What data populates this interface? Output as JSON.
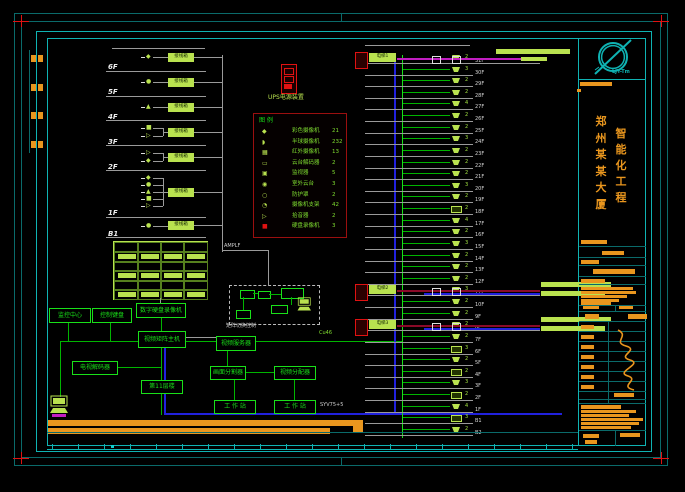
{
  "colors": {
    "teal": "#0fb3b3",
    "teal_dim": "#0a6a6a",
    "orange": "#e9961e",
    "green": "#00b400",
    "green_bright": "#19e019",
    "pale": "#b9e24f",
    "red": "#e01212",
    "blue": "#2121dd",
    "magenta": "#c21ec2",
    "maroon": "#8a0a28",
    "gray": "#9a9a9a",
    "white": "#e8e8e8"
  },
  "title_panel": {
    "logo_text": "LJY-Tm",
    "building_chars": [
      "郑",
      "州",
      "某",
      "某",
      "大",
      "厦"
    ],
    "project_chars": [
      "智",
      "能",
      "化",
      "工",
      "程"
    ]
  },
  "legend": {
    "header": "图 例",
    "items": [
      {
        "icon": "camera-icon",
        "glyph": "◆",
        "name": "彩色摄像机",
        "count": "21"
      },
      {
        "icon": "dome-camera-icon",
        "glyph": "◗",
        "name": "半球摄像机",
        "count": "232"
      },
      {
        "icon": "ir-camera-icon",
        "glyph": "▦",
        "name": "红外摄像机",
        "count": "13"
      },
      {
        "icon": "decoder-icon",
        "glyph": "▭",
        "name": "云台解码器",
        "count": "2"
      },
      {
        "icon": "monitor-icon",
        "glyph": "▣",
        "name": "监视器",
        "count": "5"
      },
      {
        "icon": "pan-tilt-icon",
        "glyph": "◉",
        "name": "室外云台",
        "count": "3"
      },
      {
        "icon": "housing-icon",
        "glyph": "○",
        "name": "防护罩",
        "count": "2"
      },
      {
        "icon": "bracket-icon",
        "glyph": "◔",
        "name": "摄像机支架",
        "count": "42"
      },
      {
        "icon": "mic-icon",
        "glyph": "▷",
        "name": "拾音器",
        "count": "2"
      },
      {
        "icon": "dvr-icon",
        "glyph": "■",
        "name": "硬盘录像机",
        "count": "3"
      }
    ]
  },
  "ups": {
    "label": "UPS电源装置"
  },
  "cables": {
    "trunk": "Cu46",
    "video": "SYV75+5",
    "amp": "AMPLF"
  },
  "left_riser": {
    "box_label": "接线箱",
    "floors": [
      {
        "label": "6F"
      },
      {
        "label": "5F"
      },
      {
        "label": "4F"
      },
      {
        "label": "3F"
      },
      {
        "label": "2F"
      },
      {
        "label": "1F"
      },
      {
        "label": "B1"
      }
    ]
  },
  "control_room": {
    "dashed_caption": "矩阵切换控制",
    "boxes": {
      "dvr": "数字硬盘录像机",
      "monitor_center": "监控中心",
      "keyboard": "控制键盘",
      "matrix": "视频矩阵主机",
      "decoder": "电视解码器",
      "floor11": "第11层楼",
      "video_server": "视频服务器",
      "splitter": "画面分割器",
      "distributor": "视频分配器",
      "ws1": "工 作 站",
      "ws2": "工 作 站"
    }
  },
  "right_riser": {
    "lift_labels": [
      "电梯1",
      "电梯2",
      "电梯3"
    ],
    "rows": [
      {
        "floor": "31F",
        "n": "2",
        "type": "dome",
        "special": 0
      },
      {
        "floor": "30F",
        "n": "3",
        "type": "dome"
      },
      {
        "floor": "29F",
        "n": "2",
        "type": "dome"
      },
      {
        "floor": "28F",
        "n": "2",
        "type": "dome"
      },
      {
        "floor": "27F",
        "n": "4",
        "type": "dome"
      },
      {
        "floor": "26F",
        "n": "2",
        "type": "dome"
      },
      {
        "floor": "25F",
        "n": "2",
        "type": "dome"
      },
      {
        "floor": "24F",
        "n": "3",
        "type": "dome"
      },
      {
        "floor": "23F",
        "n": "2",
        "type": "dome"
      },
      {
        "floor": "22F",
        "n": "2",
        "type": "dome"
      },
      {
        "floor": "21F",
        "n": "2",
        "type": "dome"
      },
      {
        "floor": "20F",
        "n": "3",
        "type": "dome"
      },
      {
        "floor": "19F",
        "n": "2",
        "type": "dome"
      },
      {
        "floor": "18F",
        "n": "2",
        "type": "box"
      },
      {
        "floor": "17F",
        "n": "4",
        "type": "dome"
      },
      {
        "floor": "16F",
        "n": "2",
        "type": "dome"
      },
      {
        "floor": "15F",
        "n": "3",
        "type": "dome"
      },
      {
        "floor": "14F",
        "n": "2",
        "type": "dome"
      },
      {
        "floor": "13F",
        "n": "2",
        "type": "dome"
      },
      {
        "floor": "12F",
        "n": "2",
        "type": "dome"
      },
      {
        "floor": "11F",
        "n": "3",
        "type": "dome",
        "special": 1
      },
      {
        "floor": "10F",
        "n": "2",
        "type": "dome"
      },
      {
        "floor": "9F",
        "n": "2",
        "type": "dome"
      },
      {
        "floor": "8F",
        "n": "2",
        "type": "dome",
        "special": 2
      },
      {
        "floor": "7F",
        "n": "2",
        "type": "dome"
      },
      {
        "floor": "6F",
        "n": "3",
        "type": "box"
      },
      {
        "floor": "5F",
        "n": "2",
        "type": "dome"
      },
      {
        "floor": "4F",
        "n": "2",
        "type": "box"
      },
      {
        "floor": "3F",
        "n": "3",
        "type": "dome"
      },
      {
        "floor": "2F",
        "n": "2",
        "type": "box"
      },
      {
        "floor": "1F",
        "n": "4",
        "type": "dome"
      },
      {
        "floor": "B1",
        "n": "3",
        "type": "box"
      },
      {
        "floor": "B2",
        "n": "2",
        "type": "dome"
      }
    ]
  }
}
